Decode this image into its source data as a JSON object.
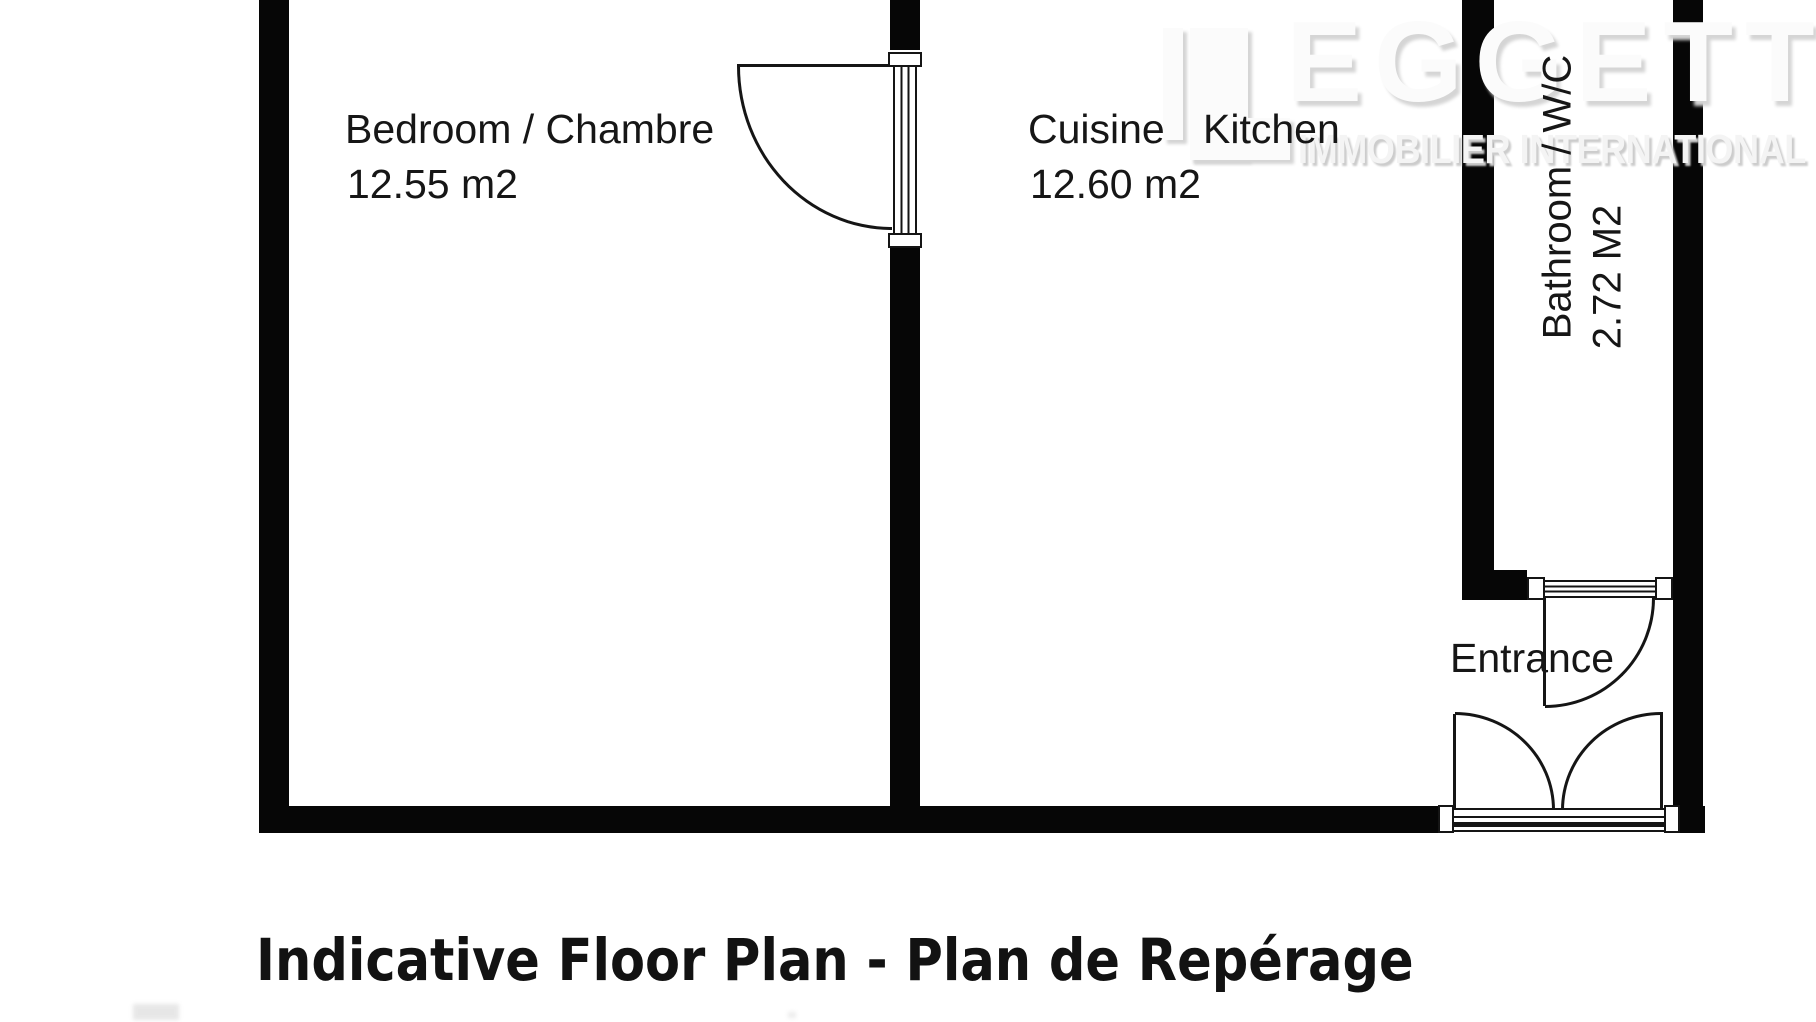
{
  "title": "Indicative Floor Plan - Plan de Repérage",
  "logo": {
    "lead_letter": "L",
    "wordmark_rest": "EGGETT",
    "tagline": "IMMOBILIER INTERNATIONAL"
  },
  "rooms": {
    "bedroom": {
      "label": "Bedroom / Chambre",
      "area": "12.55 m2"
    },
    "kitchen": {
      "label_fr": "Cuisine",
      "label_en": "Kitchen",
      "area": "12.60 m2"
    },
    "bathroom": {
      "label": "Bathroom / W/C",
      "area": "2.72 M2"
    },
    "entrance": {
      "label": "Entrance"
    }
  },
  "colors": {
    "wall": "#060606",
    "line": "#151515",
    "background": "#ffffff",
    "logo_fill": "#fbfbfb",
    "logo_shadow": "#d5d5d5",
    "label_text": "#161616"
  }
}
